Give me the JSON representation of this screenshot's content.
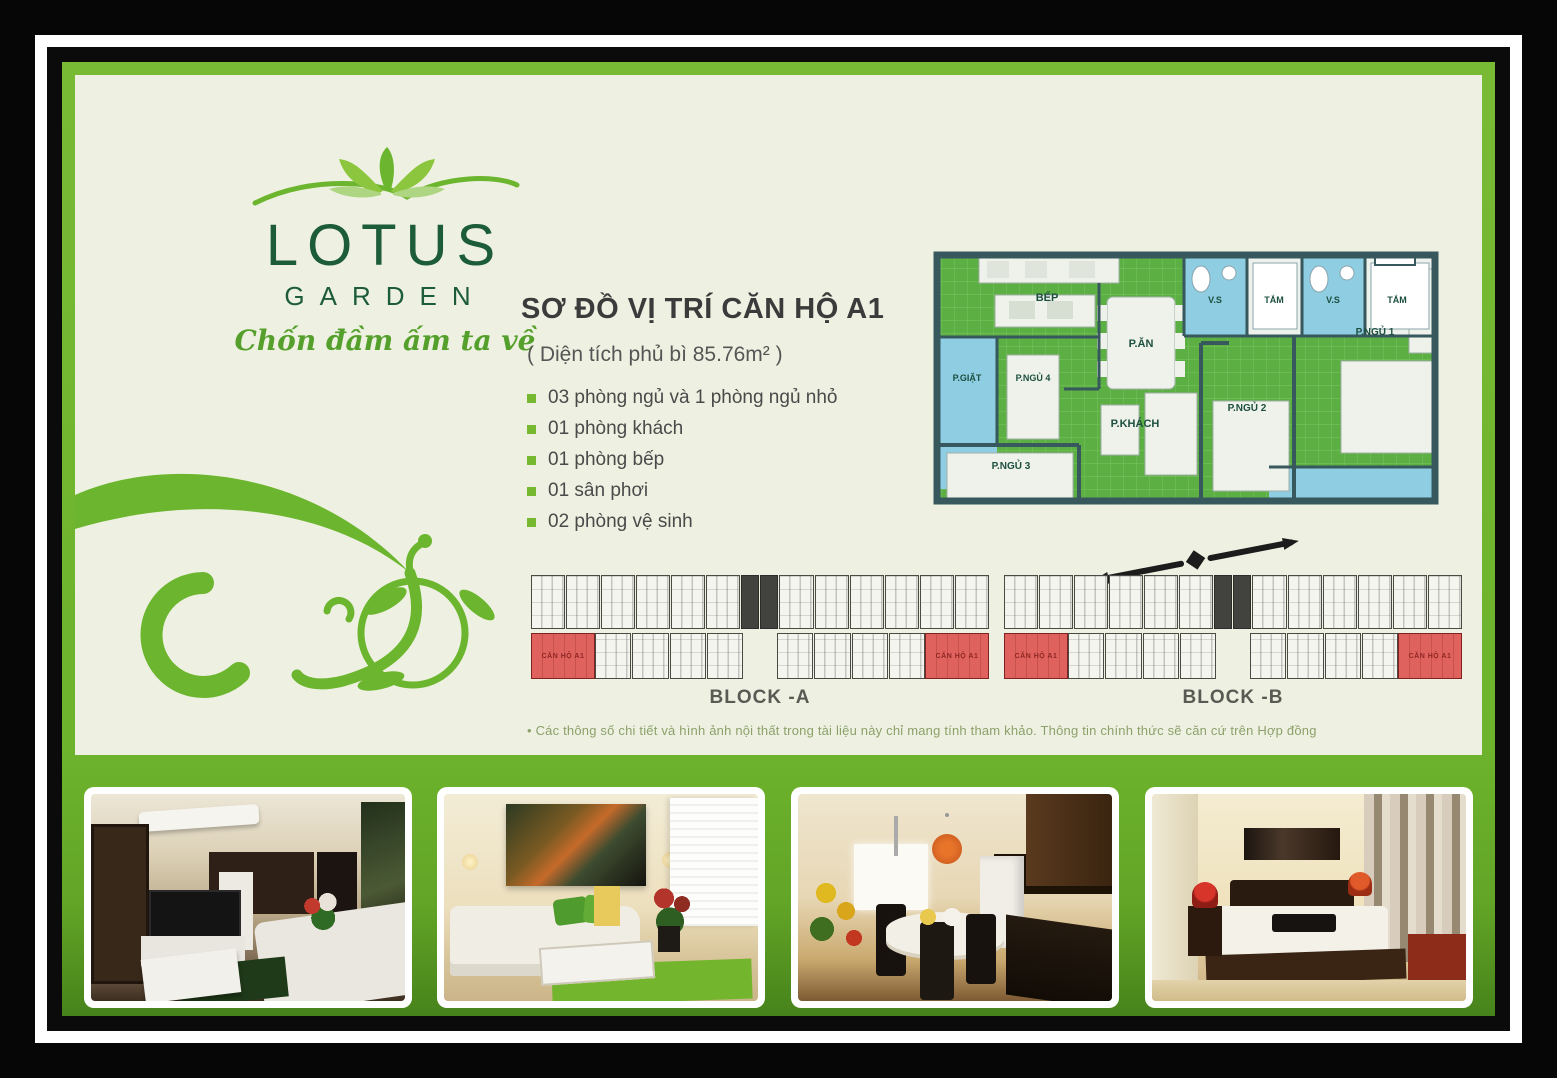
{
  "brand": {
    "name": "LOTUS",
    "subname": "GARDEN",
    "tagline": "Chốn đầm ấm ta về"
  },
  "plan": {
    "title": "SƠ ĐỒ VỊ TRÍ CĂN HỘ A1",
    "area_note": "( Diện tích phủ bì 85.76m² )",
    "features": [
      "03 phòng ngủ và 1 phòng ngủ nhỏ",
      "01 phòng khách",
      "01 phòng bếp",
      "01 sân phơi",
      "02 phòng vệ sinh"
    ]
  },
  "floor_plan": {
    "rooms": {
      "kitchen": "BẾP",
      "dining": "P.ĂN",
      "laundry": "P.GIẶT",
      "bedroom4": "P.NGỦ 4",
      "living": "P.KHÁCH",
      "bedroom3": "P.NGỦ 3",
      "bedroom2": "P.NGỦ 2",
      "bedroom1": "P.NGỦ 1",
      "wc1": "V.S",
      "bath1": "TẮM",
      "wc2": "V.S",
      "bath2": "TẮM"
    }
  },
  "blocks": {
    "a": {
      "label": "BLOCK -A",
      "unit_label": "CĂN HỘ A1"
    },
    "b": {
      "label": "BLOCK -B",
      "unit_label": "CĂN HỘ A1"
    }
  },
  "disclaimer": "• Các thông số chi tiết và hình ảnh nội thất trong tài liệu này chỉ mang tính tham khảo. Thông tin chính thức sẽ căn cứ trên Hợp đồng",
  "colors": {
    "accent_green": "#6fb52c",
    "panel_cream": "#eef1e1",
    "plan_green": "#5cb043",
    "wet_blue": "#8fcde2",
    "wall_dark": "#37585c",
    "unit_red": "#e0625e"
  }
}
